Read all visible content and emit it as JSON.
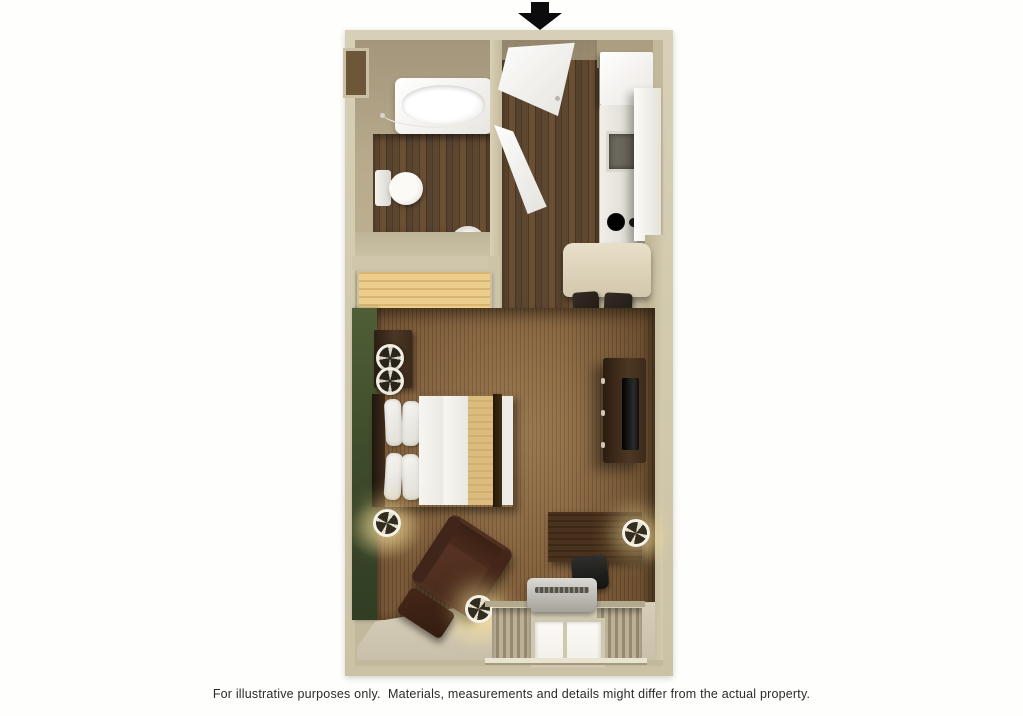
{
  "canvas": {
    "width": 1023,
    "height": 716,
    "background": "#ffffff"
  },
  "entrance_arrow": {
    "icon": "down-arrow-icon",
    "color": "#0c0c0c",
    "meaning": "unit entrance"
  },
  "caption": {
    "text": "For illustrative purposes only.  Materials, measurements and details might differ from the actual property."
  },
  "palette": {
    "wall_outer": "#cfc6ab",
    "wall_inner_tan": "#b3a68a",
    "accent_wall_green": "#46552f",
    "wood_floor_dark": "#53402d",
    "carpet_brown": "#7b5a39",
    "closet_wood": "#e3c180",
    "furniture_dark_wood": "#42301f",
    "linens_white": "#f4f3ef",
    "counter_cream": "#ddd3ba",
    "appliance_white": "#f2f1ec",
    "ac_unit_silver": "#b9b6b0",
    "curtain_taupe": "#a89c82"
  },
  "legend": {
    "rooms": [
      "bathroom",
      "entry-hall",
      "kitchen",
      "closet",
      "main-studio-room"
    ],
    "fixtures": [
      "bathtub",
      "shower-curtain-rod",
      "toilet",
      "waste-basket",
      "wall-niche",
      "entry-door",
      "bathroom-door",
      "refrigerator",
      "kitchen-counter",
      "sink",
      "cooktop-burners",
      "tall-cabinet",
      "dining-counter",
      "bar-stool",
      "bar-stool",
      "closet-shelf",
      "hanger-rod",
      "green-accent-wall",
      "nightstand",
      "table-lamp",
      "table-lamp",
      "bed-with-pillows",
      "tv-dresser",
      "television",
      "desk",
      "desk-chair",
      "desk-lamp",
      "armchair",
      "ottoman",
      "floor-lamp",
      "floor-lamp",
      "ac-unit",
      "window",
      "curtain-left",
      "curtain-right"
    ]
  }
}
